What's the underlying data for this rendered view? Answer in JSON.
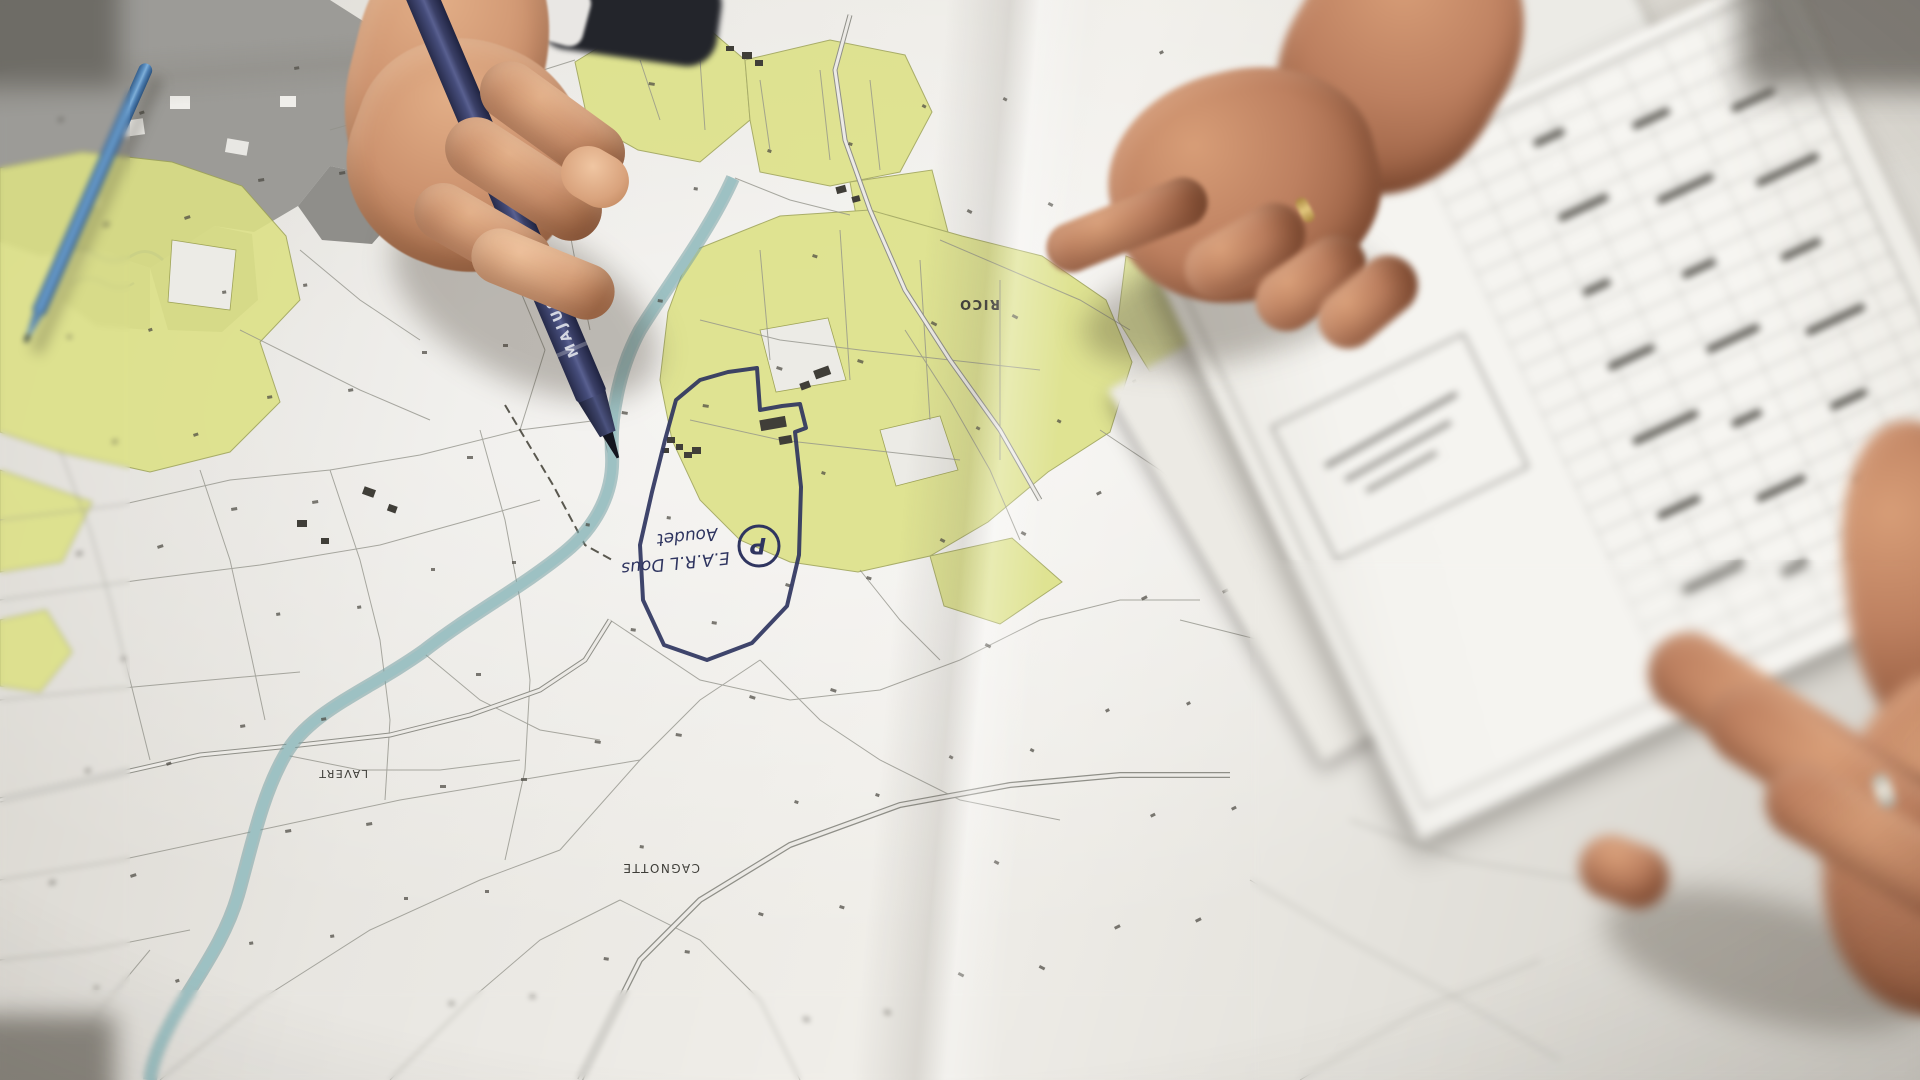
{
  "photo": {
    "marker_brand_text": "MAJUSCULE",
    "map_labels": {
      "lavert": "LAVERT",
      "cagnotte": "CAGNOTTE",
      "rico": "RICO"
    },
    "handwritten_annotation": {
      "line1": "E.A.R.L Dous",
      "line2": "Aoudet",
      "circled_letter": "P"
    },
    "colors": {
      "parcel_highlight": "#dce185",
      "stream_blue": "#9dc1c3",
      "marker_navy": "#3a3f66",
      "ballpoint_blue": "#4d7fb3",
      "annotation_ink": "#2f3560",
      "ring_gold": "#d9bc72",
      "urban_gray": "#9c9b97"
    }
  }
}
